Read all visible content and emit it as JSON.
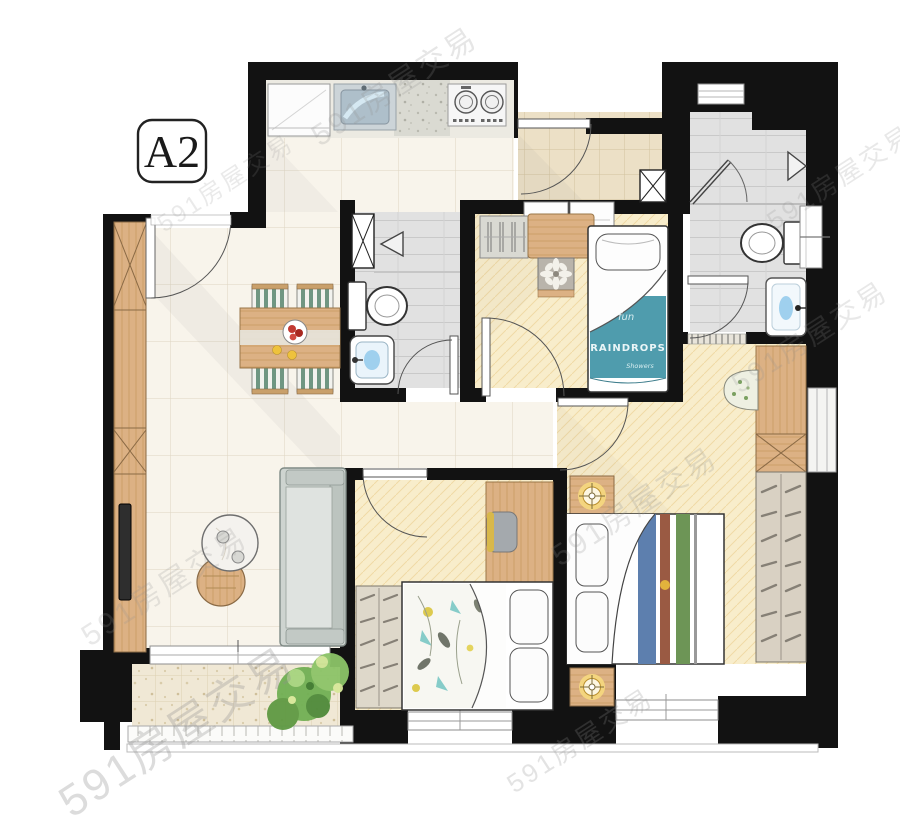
{
  "unit_label": "A2",
  "watermark_text": "591房屋交易",
  "bed_textile": {
    "top": "fun",
    "brand": "RAINDROPS",
    "sub": "Showers"
  },
  "palette": {
    "wall": "#121212",
    "marble_floor": "#f8f4eb",
    "bedroom_floor": "#f8edcb",
    "bath_floor": "#e1e1e1",
    "entry_floor": "#ece0c6",
    "balcony_floor": "#f0e8d5",
    "wood": "#dcb184",
    "sofa_gray": "#ced4d0",
    "blanket_teal": "#4f9cad",
    "stripe_blue": "#5d7fae",
    "stripe_red": "#9a5a43",
    "stripe_green": "#6d9556",
    "chair_green": "#6f9682",
    "lamp_glow": "#f6d97e",
    "plant_green": "#6fae4e",
    "sink_blue": "#9fd0ee"
  }
}
